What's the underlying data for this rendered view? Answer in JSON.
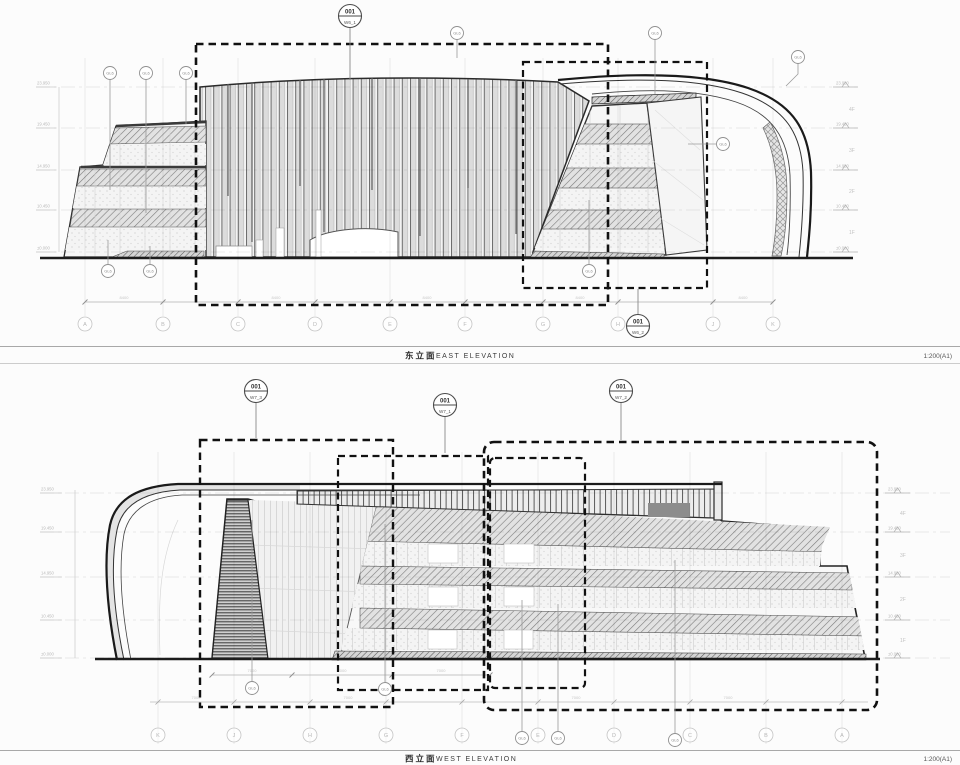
{
  "sheets": {
    "east": {
      "title_cn": "东立面",
      "title_en": "EAST ELEVATION",
      "scale": "1:200(A1)",
      "callout_top": {
        "num": "001",
        "ref": "W6_1"
      },
      "callout_bottom": {
        "num": "001",
        "ref": "W6_2"
      },
      "grid_labels": [
        "A",
        "B",
        "C",
        "D",
        "E",
        "F",
        "G",
        "H",
        "J",
        "K"
      ],
      "levels": [
        "23.950",
        "19.450",
        "14.950",
        "10.450",
        "±0.000"
      ],
      "floors": [
        "4F",
        "3F",
        "2F",
        "1F"
      ],
      "bay_dim": "8400"
    },
    "west": {
      "title_cn": "西立面",
      "title_en": "WEST ELEVATION",
      "scale": "1:200(A1)",
      "callout_left": {
        "num": "001",
        "ref": "W7_3"
      },
      "callout_mid": {
        "num": "001",
        "ref": "W7_1"
      },
      "callout_right": {
        "num": "001",
        "ref": "W7_2"
      },
      "grid_labels": [
        "K",
        "J",
        "H",
        "G",
        "F",
        "E",
        "D",
        "C",
        "B",
        "A"
      ],
      "levels": [
        "23.950",
        "19.450",
        "14.950",
        "10.450",
        "±0.000"
      ],
      "floors": [
        "4F",
        "3F",
        "2F",
        "1F"
      ],
      "bay_dim": "7000"
    }
  },
  "tags": {
    "glass": "GL6"
  }
}
